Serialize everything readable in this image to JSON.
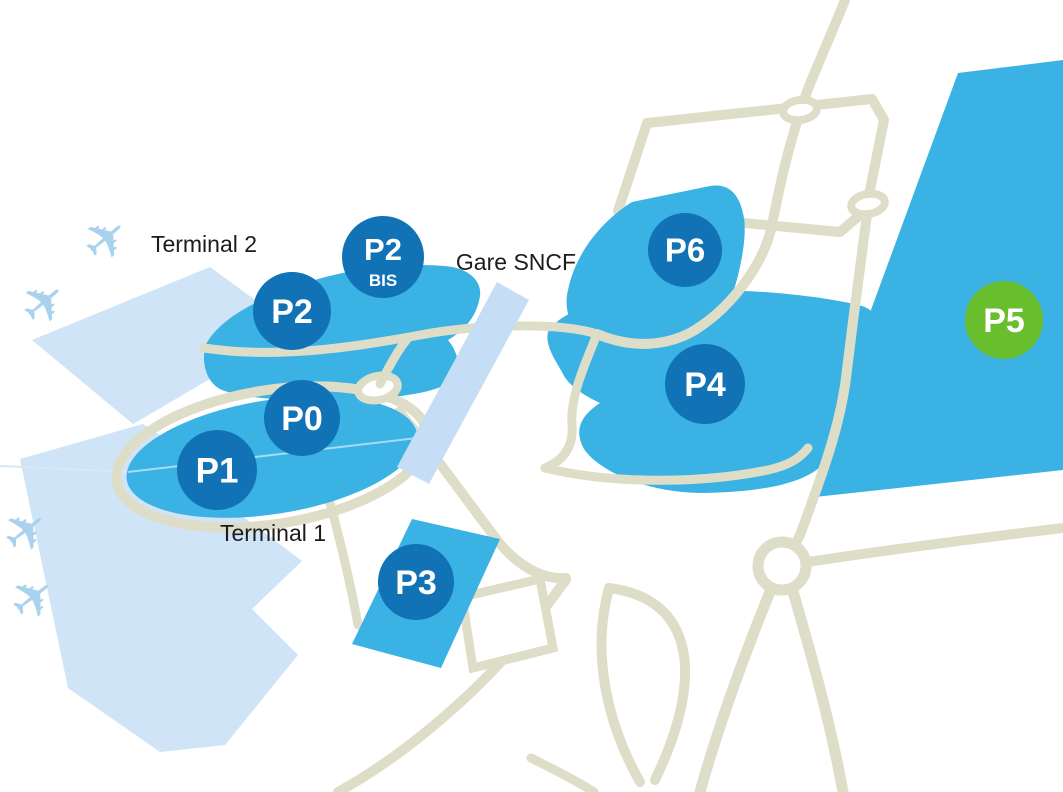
{
  "map": {
    "labels": {
      "terminal2": "Terminal 2",
      "terminal1": "Terminal 1",
      "station": "Gare SNCF"
    },
    "parkings": [
      {
        "id": "p2",
        "label": "P2",
        "color": "#1173b5"
      },
      {
        "id": "p2bis",
        "label": "P2",
        "sublabel": "BIS",
        "color": "#1173b5"
      },
      {
        "id": "p0",
        "label": "P0",
        "color": "#1173b5"
      },
      {
        "id": "p1",
        "label": "P1",
        "color": "#1173b5"
      },
      {
        "id": "p3",
        "label": "P3",
        "color": "#1173b5"
      },
      {
        "id": "p4",
        "label": "P4",
        "color": "#1173b5"
      },
      {
        "id": "p6",
        "label": "P6",
        "color": "#1173b5"
      },
      {
        "id": "p5",
        "label": "P5",
        "color": "#68be2d"
      }
    ],
    "icons": {
      "airplane": "✈"
    },
    "colors": {
      "parking_area_blue": "#3ab2e4",
      "badge_blue": "#1173b5",
      "badge_green": "#68be2d",
      "terminal_blue": "#cfe4f7",
      "airplane_blue": "#a9d2ef",
      "station_band_blue": "#c5def5",
      "road_beige": "#deddc7",
      "label_text": "#1c1c1c"
    }
  }
}
